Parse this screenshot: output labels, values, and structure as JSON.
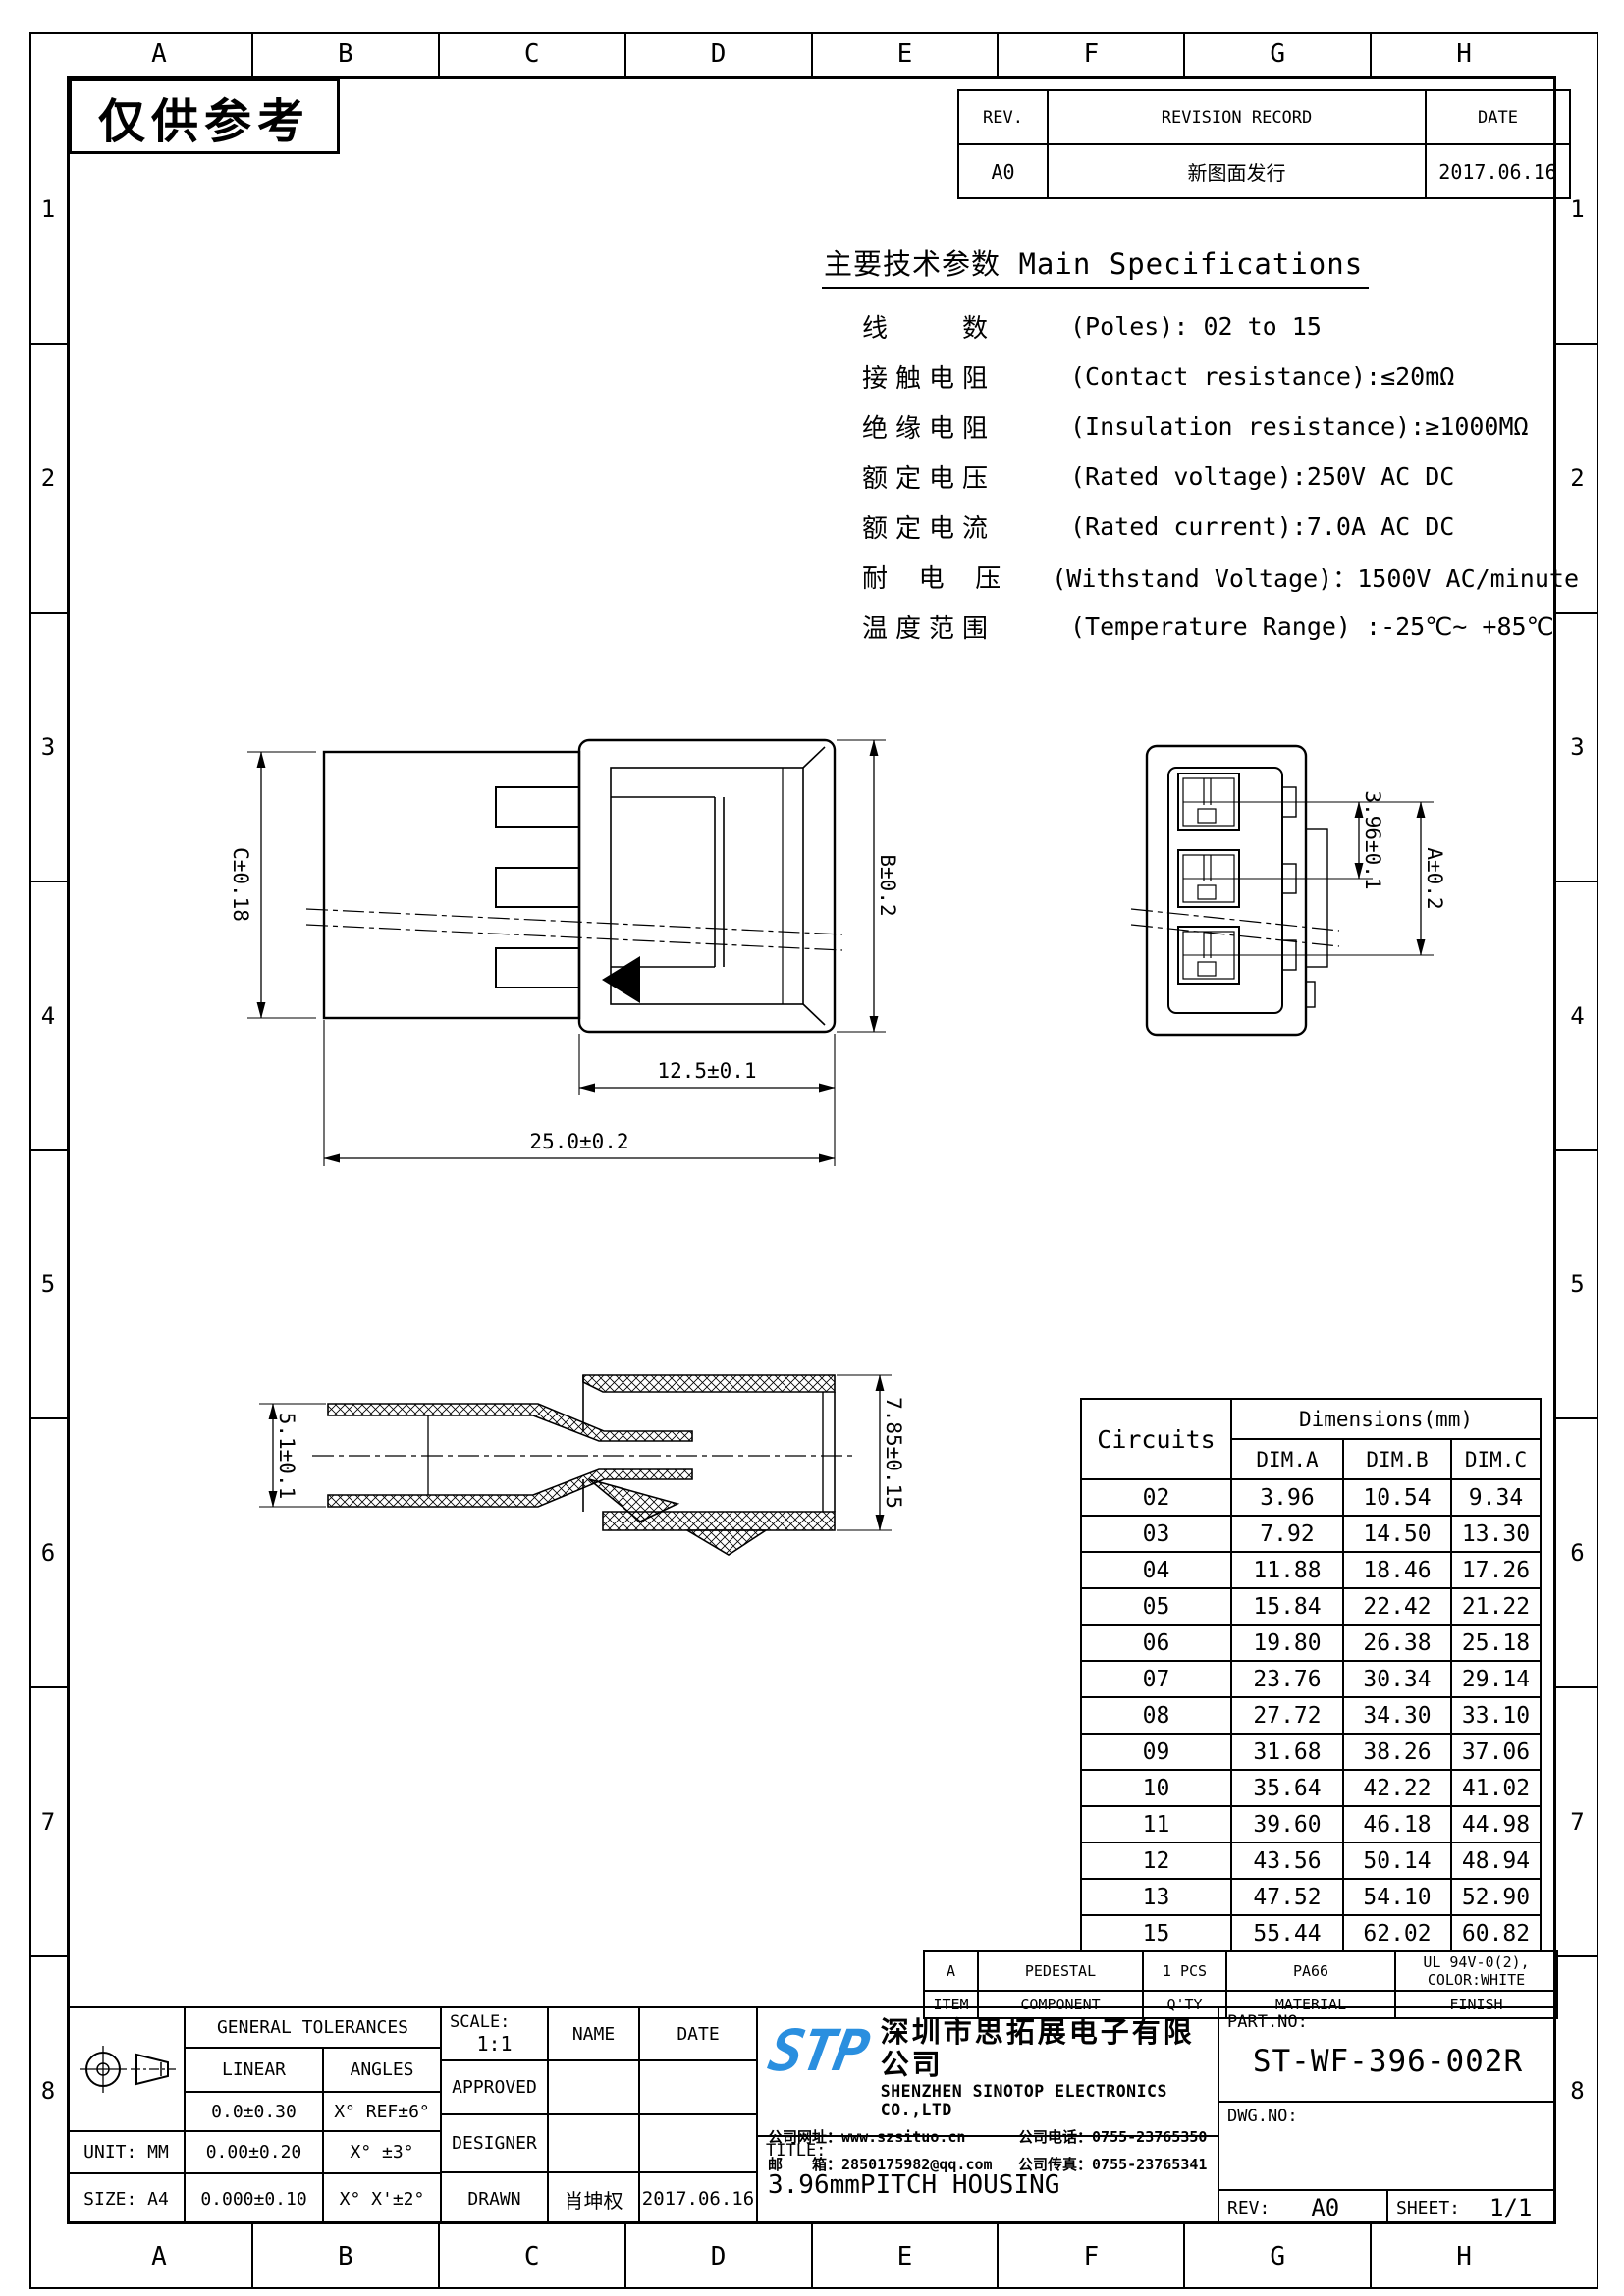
{
  "sheet": {
    "stamp": "仅供参考",
    "cols": [
      "A",
      "B",
      "C",
      "D",
      "E",
      "F",
      "G",
      "H"
    ],
    "rows_left": [
      "1",
      "2",
      "3",
      "4",
      "5",
      "6",
      "7",
      "8"
    ]
  },
  "revision": {
    "headers": [
      "REV.",
      "REVISION RECORD",
      "DATE"
    ],
    "entry": {
      "rev": "A0",
      "record": "新图面发行",
      "date": "2017.06.16"
    }
  },
  "specs": {
    "title": "主要技术参数 Main Specifications",
    "lines": [
      {
        "zh": "线　　数",
        "en": "(Poles): 02 to 15"
      },
      {
        "zh": "接触电阻",
        "en": "(Contact resistance):≤20mΩ"
      },
      {
        "zh": "绝缘电阻",
        "en": "(Insulation resistance):≥1000MΩ"
      },
      {
        "zh": "额定电压",
        "en": "(Rated voltage):250V AC DC"
      },
      {
        "zh": "额定电流",
        "en": "(Rated current):7.0A AC DC"
      },
      {
        "zh": "耐 电 压",
        "en": "(Withstand Voltage)：1500V AC/minute"
      },
      {
        "zh": "温度范围",
        "en": "(Temperature Range) :-25℃~ +85℃"
      }
    ]
  },
  "views": {
    "side": {
      "dim_c": "C±0.18",
      "dim_b": "B±0.2",
      "dim_front": "12.5±0.1",
      "dim_total": "25.0±0.2"
    },
    "front": {
      "dim_pitch": "3.96±0.1",
      "dim_a": "A±0.2"
    },
    "section": {
      "dim_inner": "5.1±0.1",
      "dim_outer": "7.85±0.15"
    }
  },
  "dim_table": {
    "col_circuits": "Circuits",
    "col_dims": "Dimensions(mm)",
    "sub_cols": [
      "DIM.A",
      "DIM.B",
      "DIM.C"
    ],
    "rows": [
      [
        "02",
        "3.96",
        "10.54",
        "9.34"
      ],
      [
        "03",
        "7.92",
        "14.50",
        "13.30"
      ],
      [
        "04",
        "11.88",
        "18.46",
        "17.26"
      ],
      [
        "05",
        "15.84",
        "22.42",
        "21.22"
      ],
      [
        "06",
        "19.80",
        "26.38",
        "25.18"
      ],
      [
        "07",
        "23.76",
        "30.34",
        "29.14"
      ],
      [
        "08",
        "27.72",
        "34.30",
        "33.10"
      ],
      [
        "09",
        "31.68",
        "38.26",
        "37.06"
      ],
      [
        "10",
        "35.64",
        "42.22",
        "41.02"
      ],
      [
        "11",
        "39.60",
        "46.18",
        "44.98"
      ],
      [
        "12",
        "43.56",
        "50.14",
        "48.94"
      ],
      [
        "13",
        "47.52",
        "54.10",
        "52.90"
      ],
      [
        "15",
        "55.44",
        "62.02",
        "60.82"
      ]
    ]
  },
  "component_table": {
    "rows": [
      [
        "A",
        "PEDESTAL",
        "1 PCS",
        "PA66",
        "UL 94V-0(2), COLOR:WHITE"
      ],
      [
        "ITEM",
        "COMPONENT",
        "Q'TY",
        "MATERIAL",
        "FINISH"
      ]
    ]
  },
  "title_block": {
    "general_tolerances": "GENERAL TOLERANCES",
    "linear": "LINEAR",
    "angles": "ANGLES",
    "tol_rows": [
      [
        "0.0±0.30",
        "X° REF±6°"
      ],
      [
        "0.00±0.20",
        "X° ±3°"
      ],
      [
        "0.000±0.10",
        "X° X'±2°"
      ]
    ],
    "unit": "UNIT: MM",
    "size": "SIZE: A4",
    "scale_label": "SCALE:",
    "scale_value": "1:1",
    "name_h": "NAME",
    "date_h": "DATE",
    "approved": "APPROVED",
    "designer": "DESIGNER",
    "drawn": "DRAWN",
    "drawn_name": "肖坤权",
    "drawn_date": "2017.06.16",
    "logo_text": "STP",
    "company_zh": "深圳市思拓展电子有限公司",
    "company_en": "SHENZHEN SINOTOP ELECTRONICS CO.,LTD",
    "website_label": "公司网址：",
    "website": "www.szsituo.cn",
    "phone_label": "公司电话：",
    "phone": "0755-23765350",
    "email_label": "邮　　箱：",
    "email": "2850175982@qq.com",
    "fax_label": "公司传真：",
    "fax": "0755-23765341",
    "title_label": "TITLE:",
    "title_value": "3.96mmPITCH HOUSING",
    "partno_label": "PART.NO:",
    "partno_value": "ST-WF-396-002R",
    "dwgno_label": "DWG.NO:",
    "rev_label": "REV:",
    "rev_value": "A0",
    "sheet_label": "SHEET:",
    "sheet_value": "1/1"
  }
}
